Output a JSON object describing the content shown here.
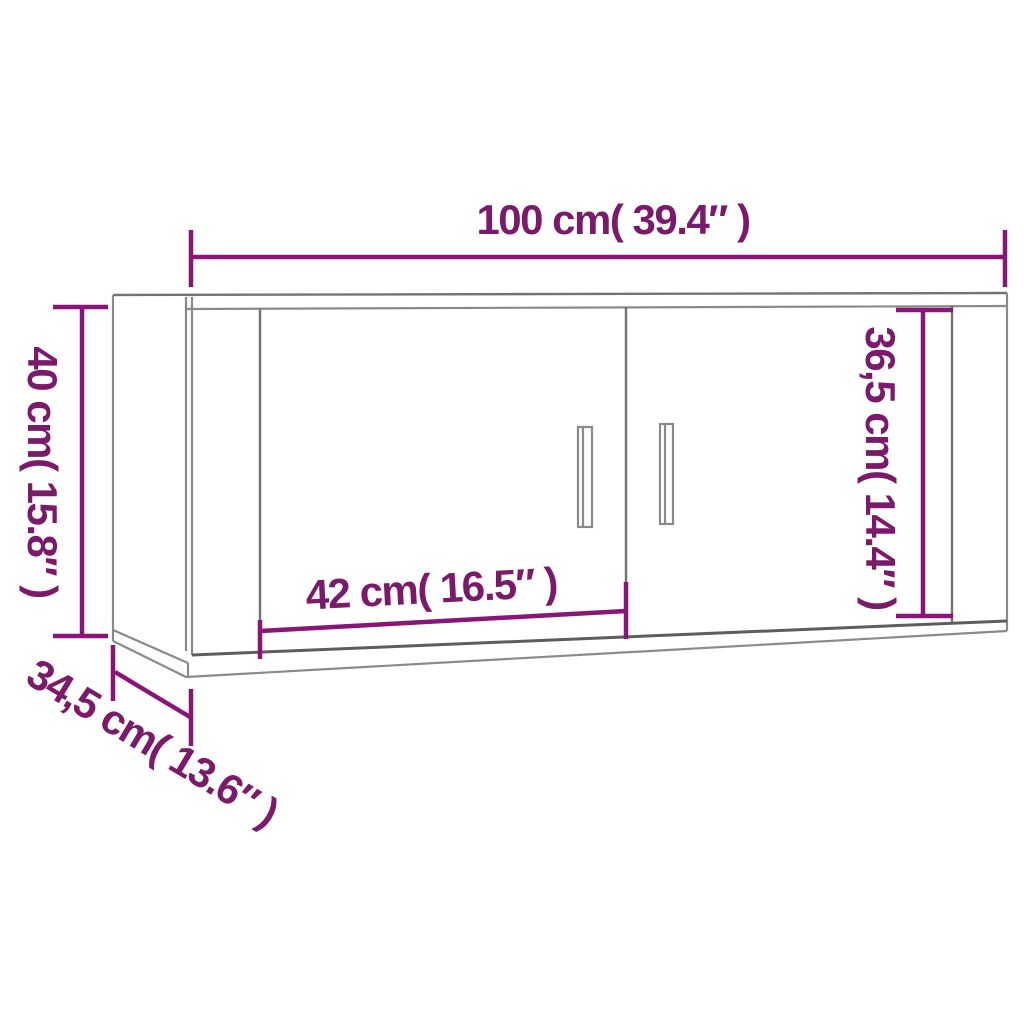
{
  "diagram": {
    "colors": {
      "dimension_line": "#8b1478",
      "dimension_text": "#7b1a6a",
      "outline_light": "#8a8a8a",
      "outline_dark": "#5d5d5d",
      "background": "#ffffff"
    },
    "dimensions": {
      "width": {
        "label": "100 cm( 39.4″ )",
        "cm": 100,
        "inch": 39.4,
        "position": "top"
      },
      "height": {
        "label": "40 cm( 15.8″ )",
        "cm": 40,
        "inch": 15.8,
        "position": "left"
      },
      "door_width": {
        "label": "42 cm( 16.5″ )",
        "cm": 42,
        "inch": 16.5,
        "position": "inside-left-door"
      },
      "door_height": {
        "label": "36,5 cm( 14.4″ )",
        "cm": 36.5,
        "inch": 14.4,
        "position": "inside-right"
      },
      "depth": {
        "label": "34,5 cm( 13.6″ )",
        "cm": 34.5,
        "inch": 13.6,
        "position": "bottom-left-diagonal"
      }
    }
  }
}
